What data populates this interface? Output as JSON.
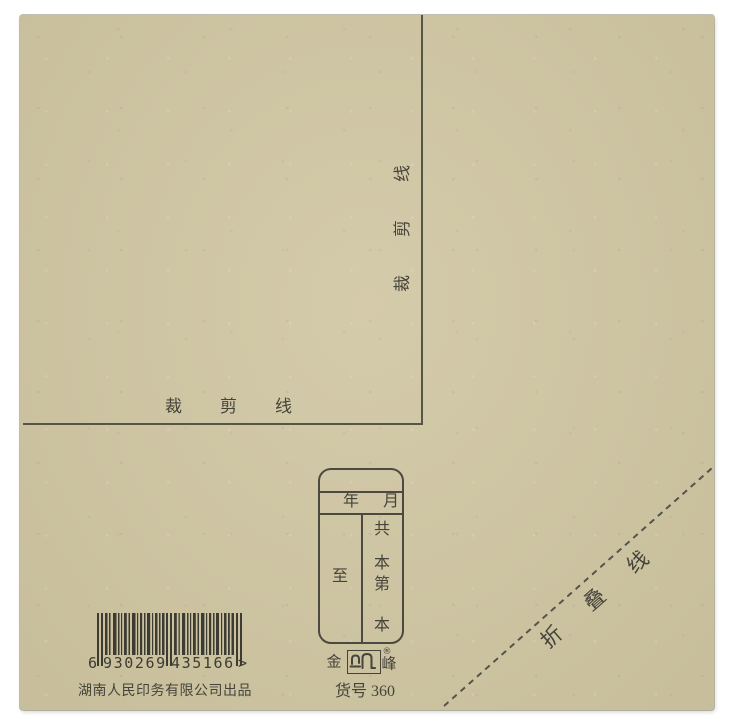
{
  "paper": {
    "background_color": "#cfc5a2",
    "ink_color": "#45443a"
  },
  "cut_line": {
    "label": "裁剪线",
    "vertical_chars": [
      "线",
      "剪",
      "裁"
    ],
    "horizontal_chars": [
      "裁",
      "剪",
      "线"
    ]
  },
  "stamp": {
    "year_label": "年",
    "month_label": "月",
    "to_label": "至",
    "total_label": "共",
    "volume_unit_top": "本",
    "number_label": "第",
    "volume_unit_bottom": "本"
  },
  "brand": {
    "left_char": "金",
    "right_char": "峰",
    "registered_mark": "®"
  },
  "barcode": {
    "lead_digit": "6",
    "group1": "930269",
    "group2": "435166",
    "end_mark": ">"
  },
  "manufacturer_line": "湖南人民印务有限公司出品",
  "product_code_line": "货号 360",
  "fold_line": {
    "label": "折叠线",
    "chars": [
      "折",
      "叠",
      "线"
    ]
  }
}
